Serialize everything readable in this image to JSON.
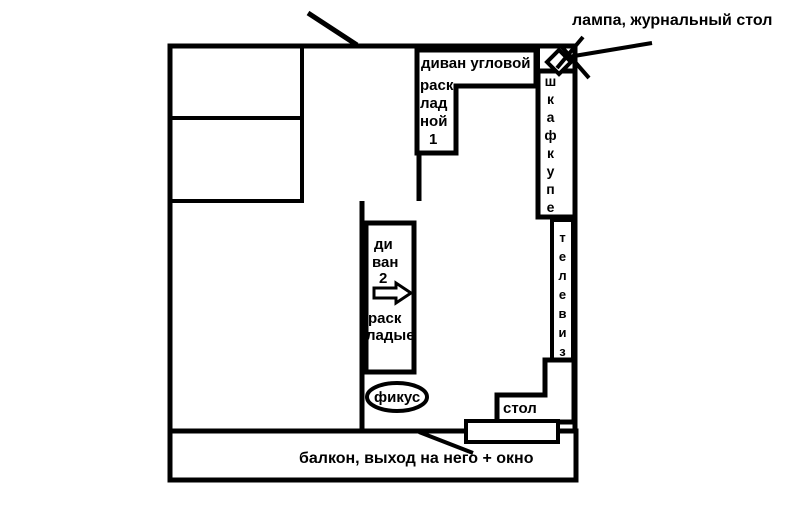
{
  "colors": {
    "ink": "#000000",
    "background": "#ffffff"
  },
  "annotations": {
    "lamp_table": "лампа, журнальный стол",
    "balcony": "балкон, выход на него + окно"
  },
  "furniture": {
    "corner_sofa": {
      "title": "диван угловой",
      "lines": [
        "раск",
        "лад",
        "ной",
        "1"
      ]
    },
    "wardrobe": {
      "label": "шкафкупе"
    },
    "tv": {
      "label": "телевиз"
    },
    "sofa2": {
      "lines": [
        "ди",
        "ван",
        "2"
      ],
      "lines2": [
        "раск",
        "ладые"
      ]
    },
    "ficus": {
      "label": "фикус"
    },
    "table": {
      "label": "стол"
    }
  }
}
